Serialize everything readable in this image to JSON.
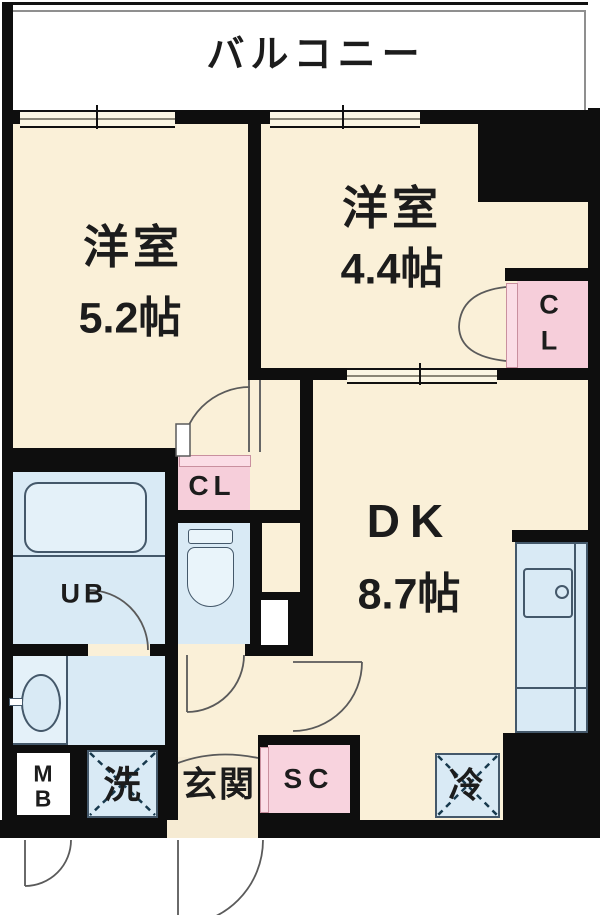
{
  "title": "apartment-floor-plan",
  "colors": {
    "floor": "#FAF0D8",
    "water_blue": "#D9EAF5",
    "closet_pink": "#F6CEDA",
    "closet_door_pink": "#FBDDE6",
    "wall_black": "#0e0e0e",
    "fixture_line": "#44586a"
  },
  "balcony": {
    "label": "バルコニー"
  },
  "rooms": {
    "western1": {
      "name": "洋室",
      "area": "5.2帖"
    },
    "western2": {
      "name": "洋室",
      "area": "4.4帖"
    },
    "dk": {
      "name": "DK",
      "area": "8.7帖"
    },
    "unit_bath": {
      "label": "UB"
    },
    "closet_hall": {
      "label": "CL"
    },
    "closet_right": {
      "line1": "C",
      "line2": "L"
    },
    "shoe_closet": {
      "label": "SC"
    },
    "meter_box": {
      "line1": "M",
      "line2": "B"
    },
    "entrance": {
      "label": "玄関"
    },
    "washer": {
      "label": "洗"
    },
    "refrigerator": {
      "label": "冷"
    }
  }
}
